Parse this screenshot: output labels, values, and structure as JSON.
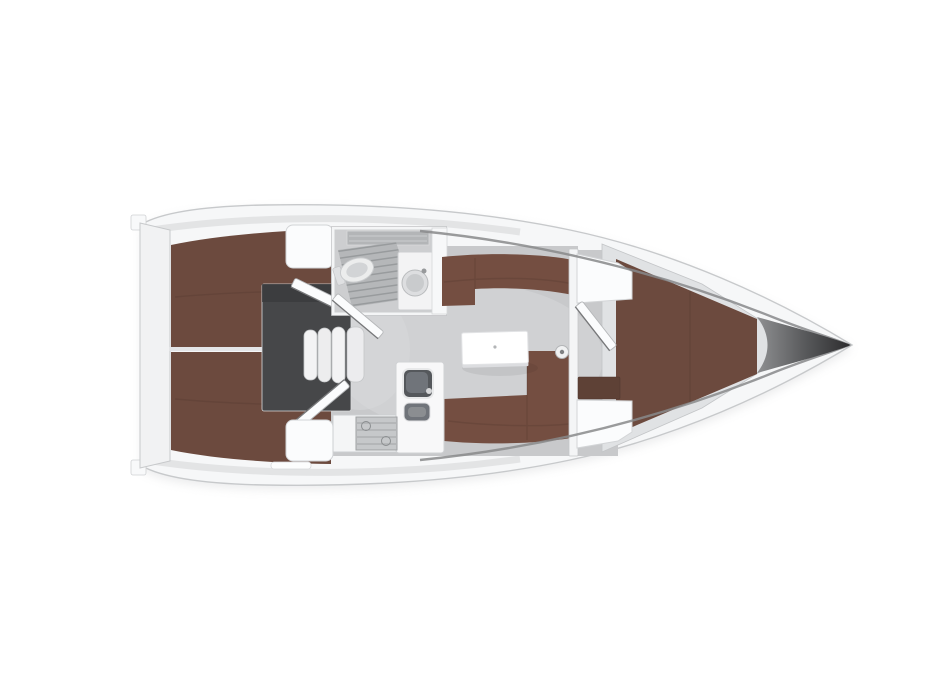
{
  "canvas": {
    "width": 933,
    "height": 700
  },
  "plan": {
    "type": "sailing-yacht-interior-floor-plan",
    "orientation": "bow-right",
    "features": [
      "hull",
      "transom",
      "aft-cabin-port-berth",
      "aft-cabin-starboard-berth",
      "engine-compartment",
      "companionway-steps",
      "aft-cabin-port-door",
      "aft-cabin-starboard-door",
      "cockpit-locker-top",
      "cockpit-locker-bottom",
      "head-compartment",
      "shower-grate",
      "toilet",
      "washbasin",
      "head-door",
      "saloon-floor",
      "saloon-settee-port",
      "saloon-settee-starboard",
      "saloon-table",
      "mast-post",
      "galley-counter",
      "galley-sink",
      "galley-stove",
      "saloon-bulkhead",
      "forward-cabin-door",
      "forward-cabin-locker-top",
      "forward-cabin-locker-bottom",
      "forward-cabin-bench",
      "v-berth",
      "bow"
    ],
    "counts": {
      "companionway_steps": 4,
      "stove_burners": 2,
      "cabins": 3
    }
  },
  "palette": {
    "background": "#ffffff",
    "hull_fill": "#f6f7f8",
    "hull_stroke": "#c7c9cb",
    "hull_shadow": "#d2d3d5",
    "deck_streak": "#dfe0e2",
    "sheer_line": "#88898b",
    "bow_dark": "#2b2b2d",
    "bow_mid": "#97989a",
    "transom_fill": "#f1f2f3",
    "floor": "#c8c9cb",
    "floor_light": "#d6d7d9",
    "berth": "#6c4a3e",
    "berth_dark": "#5e4136",
    "settee": "#744e41",
    "engine": "#464749",
    "step_fill": "#f3f3f4",
    "step_stroke": "#c4c6c8",
    "fixture": "#f4f5f6",
    "fixture_stroke": "#cdcfd1",
    "wall": "#f4f5f6",
    "wall_stroke": "#c5c7c9",
    "grate": "#b5b7b9",
    "grate_stripe": "#989b9d",
    "head_floor": "#cdced0",
    "sink_dark": "#55585c",
    "sink_mid": "#70747a",
    "stove": "#c6c8ca",
    "stove_line": "#95989a",
    "table": "#ffffff",
    "table_stroke": "#e2e3e5",
    "band_silver": "#e0e2e4"
  }
}
